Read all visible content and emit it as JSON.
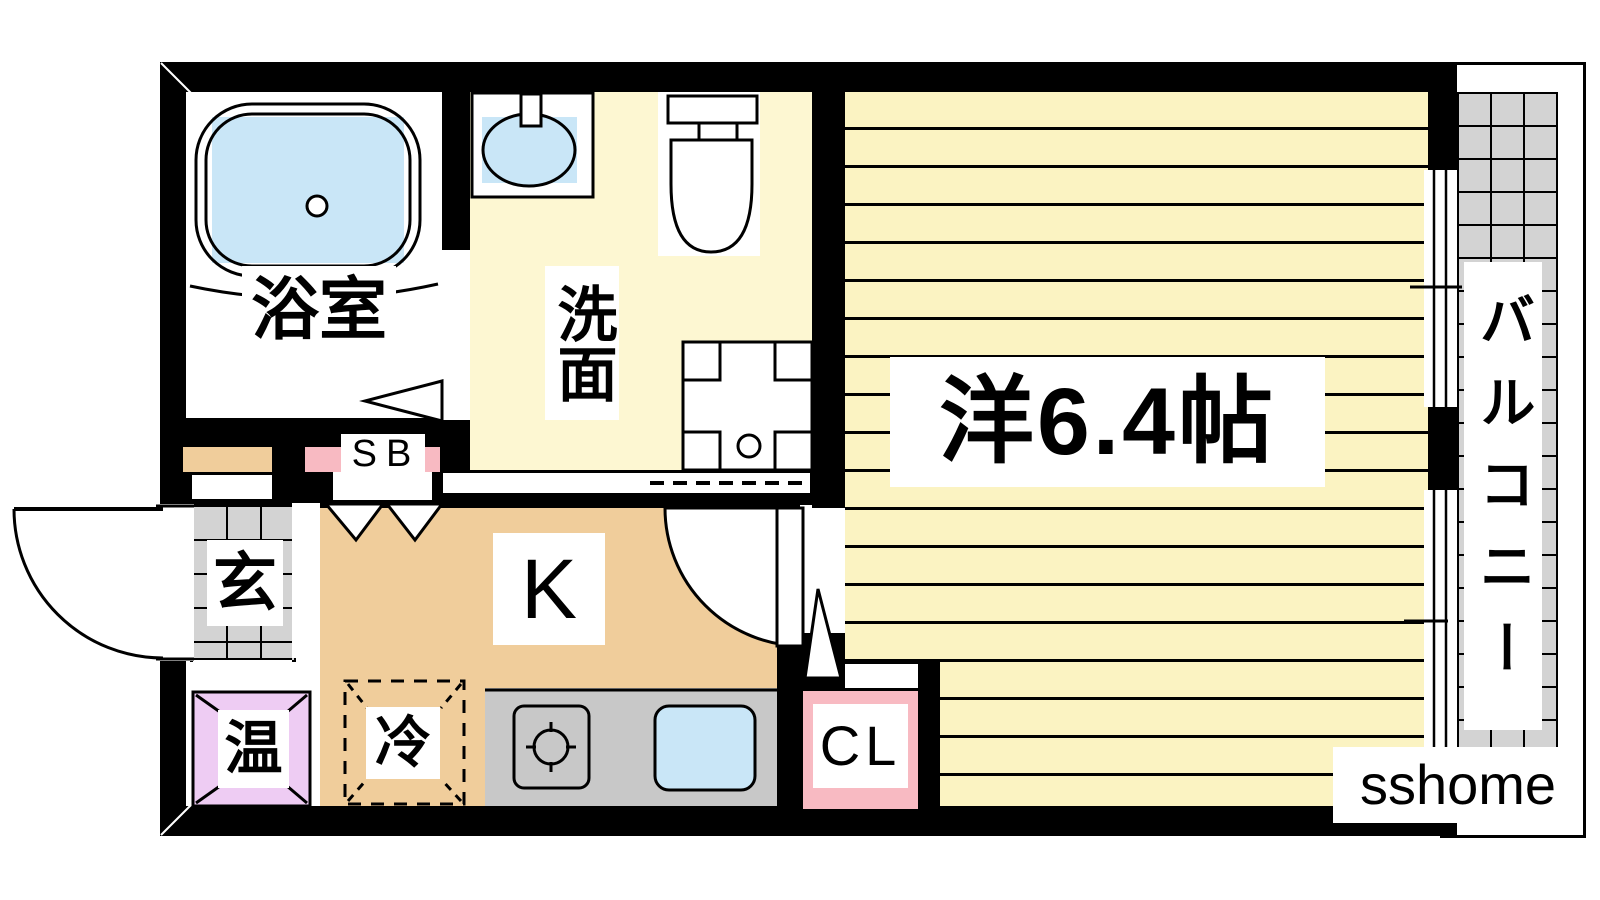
{
  "plan": {
    "bathroom_label": "浴室",
    "washroom_label": "洗面",
    "shoe_box_label": "SB",
    "entrance_label": "玄",
    "kitchen_label": "K",
    "water_heater_label": "温",
    "refrigerator_label": "冷",
    "closet_label": "CL",
    "main_room_label": "洋6.4帖",
    "balcony_label": "バルコニー"
  },
  "branding": {
    "logo_text": "sshome"
  },
  "colors": {
    "wall": "#000000",
    "room_yellow": "#fbf3c2",
    "washroom_yellow": "#fdf7d2",
    "kitchen_tan": "#f0cd9b",
    "tile_gray": "#d3d3d3",
    "counter_gray": "#c8c8c8",
    "water_blue": "#c9e6f7",
    "heater_purple": "#eeccf3",
    "closet_pink": "#f8bac2",
    "label_bg": "#ffffff"
  }
}
